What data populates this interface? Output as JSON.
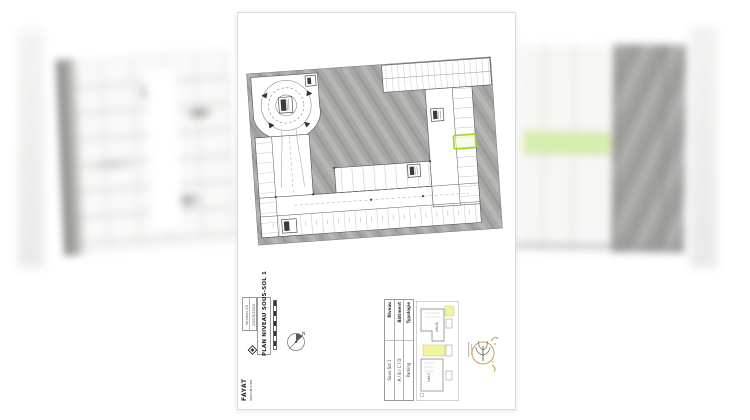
{
  "sheet": {
    "title": "PLAN NIVEAU SOUS-SOL 1",
    "date": "25/09/2024",
    "version": "Version 00",
    "publisher": {
      "name": "FAYAT",
      "division": "IMMOBILIER"
    },
    "compass": {
      "north_label": "N"
    },
    "info_table": {
      "rows": [
        {
          "label": "Typologie",
          "value": "Parking"
        },
        {
          "label": "Bâtiment",
          "value": "A / B / C / D"
        },
        {
          "label": "Niveau",
          "value": "Sous-Sol 1"
        }
      ]
    },
    "key_plan": {
      "labels": [
        "bât.B",
        "bât.C"
      ]
    },
    "colors": {
      "highlight_green": "#a4d422",
      "keyplan_yellow": "#f2f2a0",
      "surround_gray": "#a8a8a6",
      "logo_gold": "#c9a258"
    }
  }
}
